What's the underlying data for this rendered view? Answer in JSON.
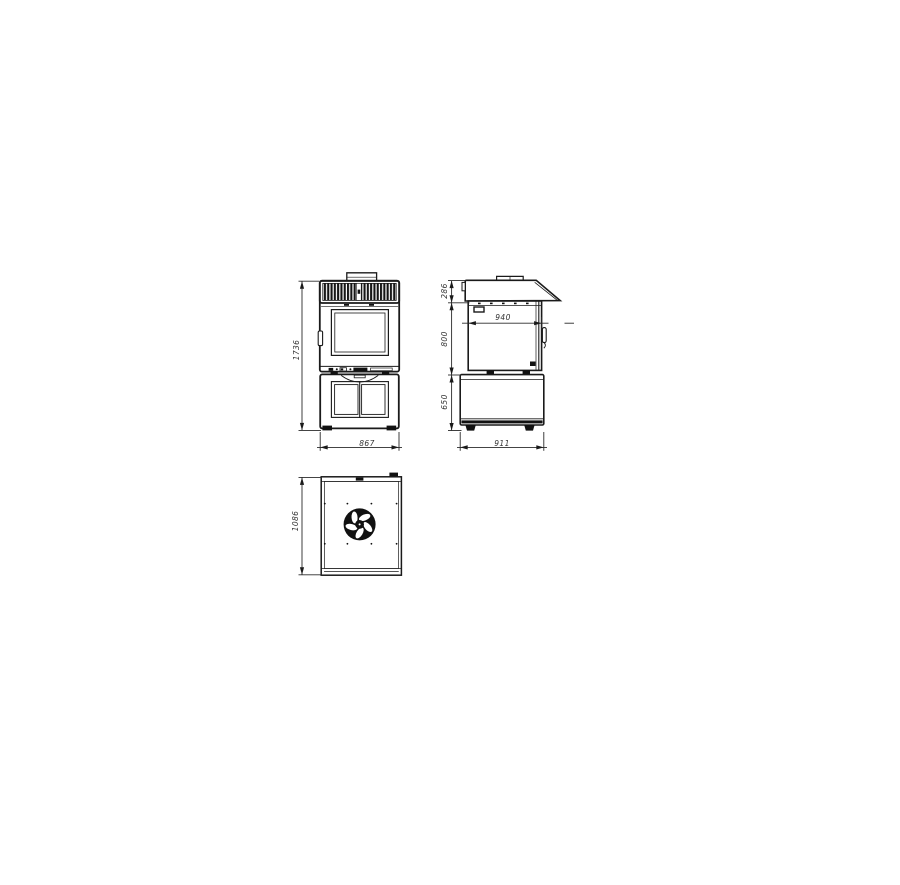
{
  "dimensions": {
    "front": {
      "overall_height": "1736",
      "overall_width": "867"
    },
    "side": {
      "hood_height": "286",
      "oven_body_height": "800",
      "stand_height": "650",
      "oven_depth_inner": "940",
      "overall_depth": "911"
    },
    "rear": {
      "panel_height": "1086"
    }
  },
  "colors": {
    "background": "#ffffff",
    "line": "#1a1a1a",
    "dim_line": "#2a2a2a",
    "label": "#333333"
  }
}
